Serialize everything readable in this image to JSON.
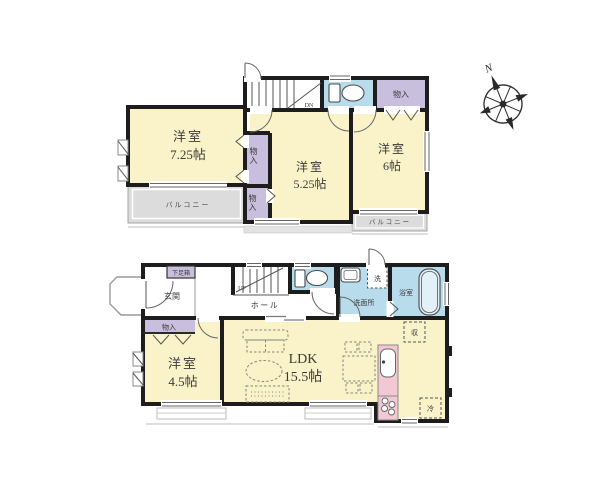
{
  "floor2": {
    "room_a": {
      "name": "洋室",
      "size": "7.25帖"
    },
    "room_b": {
      "name": "洋室",
      "size": "5.25帖"
    },
    "room_c": {
      "name": "洋室",
      "size": "6帖"
    },
    "closet_upper": "物入",
    "closet_lower": "物入",
    "closet_right": "物入",
    "balcony_left": "バルコニー",
    "balcony_right": "バルコニー",
    "stairs_label": "DN"
  },
  "floor1": {
    "entrance": "玄関",
    "shoe_cabinet": "下足箱",
    "hall": "ホール",
    "stairs_label": "UP",
    "washroom": "洗面所",
    "washing_machine": "洗",
    "bathroom": "浴室",
    "closet": "物入",
    "room_d": {
      "name": "洋室",
      "size": "4.5帖"
    },
    "ldk": {
      "name": "LDK",
      "size": "15.5帖"
    },
    "storage": "収",
    "refrigerator": "冷"
  },
  "compass": {
    "north": "N"
  },
  "colors": {
    "room_yellow": "#FAF3C9",
    "closet_purple": "#C8BEDD",
    "wet_blue": "#B9DCEC",
    "balcony_gray": "#DCDCDC",
    "kitchen_pink": "#F2C9D3",
    "wall": "#1D1D1D"
  }
}
